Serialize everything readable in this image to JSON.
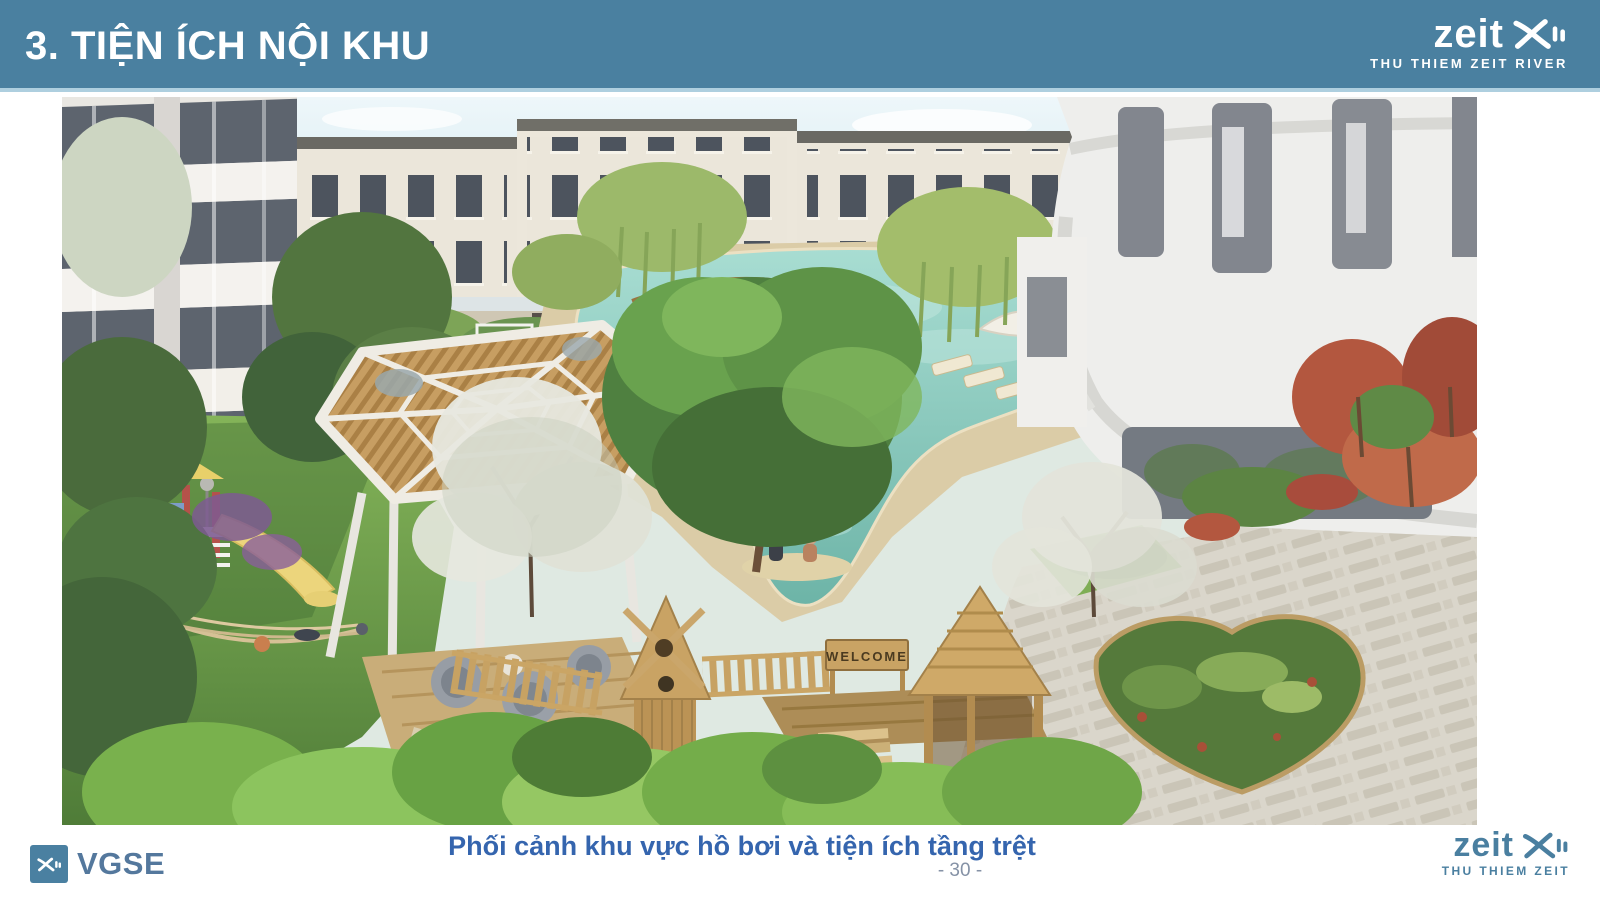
{
  "header": {
    "title": "3. TIỆN ÍCH NỘI KHU"
  },
  "logo_top_right": {
    "wordmark": "zeit",
    "mark": "XII",
    "tagline": "THU THIEM ZEIT RIVER"
  },
  "logo_bottom_right": {
    "wordmark": "zeit",
    "mark": "XII",
    "tagline": "THU THIEM ZEIT"
  },
  "logo_bottom_left": {
    "wordmark": "VGSE",
    "mark": "XII"
  },
  "figure": {
    "caption": "Phối cảnh khu vực hồ bơi và tiện ích tầng trệt",
    "welcome_sign_text": "WELCOME"
  },
  "footer": {
    "page_number": "- 30 -"
  },
  "colors": {
    "header_bg": "#4A80A0",
    "header_underline": "#AECFDF",
    "caption_text": "#3565AE",
    "page_number_text": "#8592A6",
    "brand_blue": "#4A7FA0",
    "vgse_text": "#54789D",
    "pool_water": "#8FCCC2"
  }
}
